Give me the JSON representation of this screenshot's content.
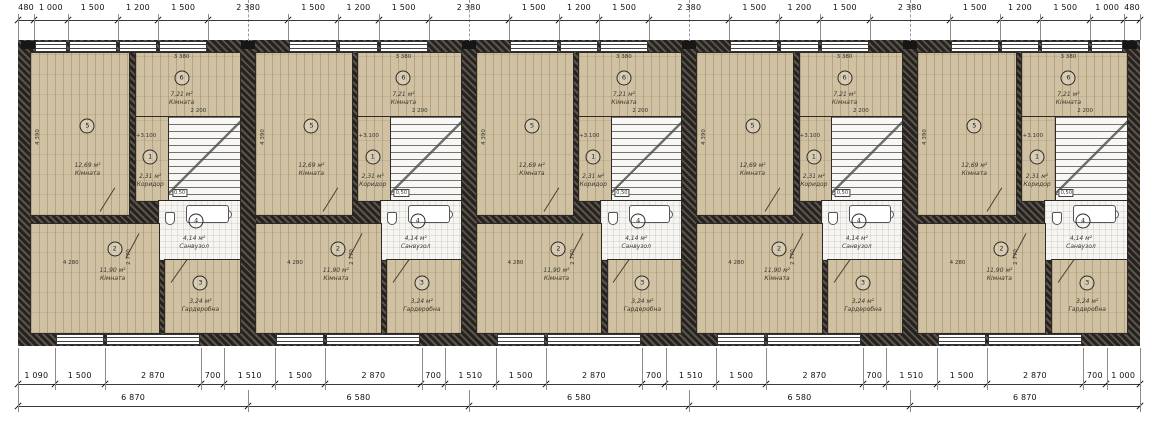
{
  "dims": {
    "top": [
      "480",
      "1 000",
      "1 500",
      "1 200",
      "1 500",
      "2 380",
      "1 500",
      "1 200",
      "1 500",
      "2 380",
      "1 500",
      "1 200",
      "1 500",
      "2 380",
      "1 500",
      "1 200",
      "1 500",
      "2 380",
      "1 500",
      "1 200",
      "1 500",
      "1 000",
      "480"
    ],
    "bottom": [
      "1 090",
      "1 500",
      "2 870",
      "700",
      "1 510",
      "1 500",
      "2 870",
      "700",
      "1 510",
      "1 500",
      "2 870",
      "700",
      "1 510",
      "1 500",
      "2 870",
      "700",
      "1 510",
      "1 500",
      "2 870",
      "700",
      "1 000"
    ],
    "totals": [
      "6 870",
      "6 580",
      "6 580",
      "6 580",
      "6 870"
    ]
  },
  "units_count": 5,
  "unit": {
    "rooms": [
      {
        "num": "5",
        "area": "12,69 м²",
        "name": "Кімната"
      },
      {
        "num": "6",
        "area": "7,21 м²",
        "name": "Кімната"
      },
      {
        "num": "1",
        "area": "2,31 м²",
        "name": "Коридор"
      },
      {
        "num": "4",
        "area": "4,14 м²",
        "name": "Санвузол"
      },
      {
        "num": "2",
        "area": "11,90 м²",
        "name": "Кімната"
      },
      {
        "num": "3",
        "area": "3,24 м²",
        "name": "Гардеробна"
      }
    ],
    "annotations": {
      "elevation": "+3.100",
      "dim_3380": "3 380",
      "dim_2200": "2 200",
      "dim_4280": "4 280",
      "dim_4390": "4 390",
      "dim_2770": "2 770",
      "shaft": "0,50"
    }
  },
  "colors": {
    "wood_floor": "#cfc1a1",
    "wall_hatch_dark": "#262220",
    "white_room": "#f6f5f1",
    "line": "#3a3a3a"
  }
}
